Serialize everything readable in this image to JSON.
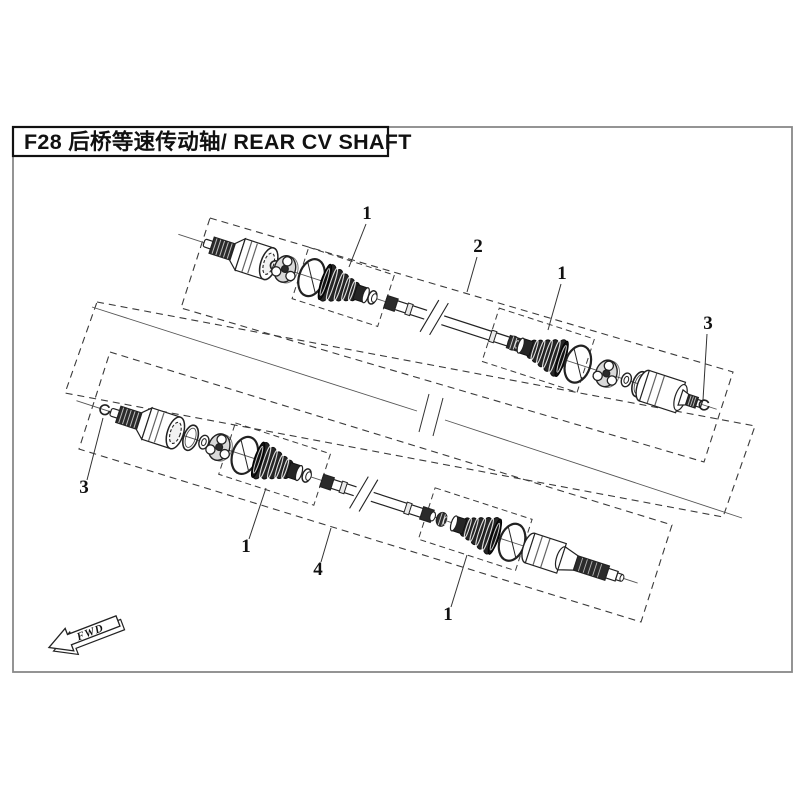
{
  "title": {
    "text": "F28 后桥等速传动轴/ REAR CV SHAFT"
  },
  "fwd": {
    "label": "FWD"
  },
  "callouts": [
    {
      "label": "1"
    },
    {
      "label": "2"
    },
    {
      "label": "1"
    },
    {
      "label": "3"
    },
    {
      "label": "3"
    },
    {
      "label": "1"
    },
    {
      "label": "4"
    },
    {
      "label": "1"
    }
  ],
  "colors": {
    "ink": "#222222",
    "page_border": "#888888",
    "boot_fill": "#262626",
    "background": "#ffffff"
  }
}
